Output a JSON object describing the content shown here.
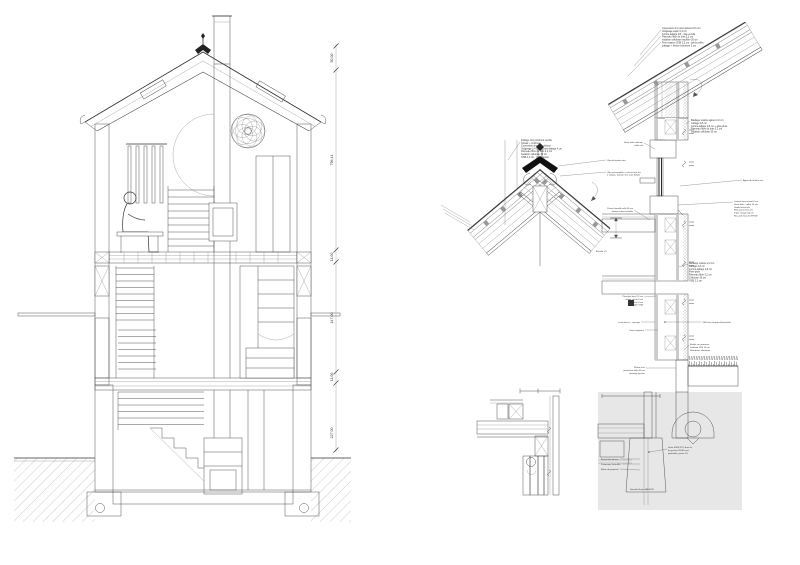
{
  "section": {
    "dimensions": [
      "50,00",
      "796,44",
      "11,00",
      "147,00",
      "11,00",
      "227,00"
    ]
  },
  "details": {
    "eave": {
      "notes": [
        "Couverture zinc joint debout 0,8 mm",
        "Voligeage sapin 2,4 cm",
        "Contre-lattage 4/6 - vide ventilé",
        "Panneau fibre de bois 2,2 cm",
        "Isolation cellulose insufflée 30 cm",
        "Frein-vapeur OSB 2,2 cm - joints collés",
        "Lattage + finition intérieure 2 cm"
      ]
    },
    "ridge": {
      "notes": [
        "Faîtage zinc préformé ventilé",
        "Closoir + crochets",
        "Couverture zinc joint debout",
        "Voligeage 2,4 cm - contre-lattage 4 cm",
        "Panneau fibre de bois 2,2 cm",
        "Isolation cellulose 30 cm",
        "OSB 2,2 cm - pare-vapeur"
      ],
      "note_right1": "Clip de fixation zinc",
      "notes_right2": [
        "Clip anti-tempête - crochet tous les",
        "2 voliges, fixation inox (voir détail)"
      ],
      "note_bottom": "Échelle 1:5"
    },
    "wall": {
      "notes_a": [
        "Bardage mélèze ajouré 2,2 cm",
        "Lattage 2,8 cm",
        "Contre-lattage 2,8 cm + pare-pluie",
        "Panneau fibre de bois 2,2 cm",
        "Isolation cellulose 30 cm"
      ],
      "note_b": "Appui de fenêtre zinc",
      "notes_c": [
        "Linteau bois massif 6 cm",
        "Store toile - coffre 10 cm",
        "Guide latéral alu",
        "Menuiserie bois-alu",
        "Triple vitrage Ug 0,6",
        "Raccord étanche EPDM"
      ],
      "notes_d": [
        "Bardage mélèze 2,2 cm",
        "Lattage 2,8 cm",
        "Contre-lattage 2,8 cm",
        "Pare-pluie",
        "Panneau fibre 2,2 cm",
        "Cellulose 30 cm",
        "OSB 2,2 cm"
      ],
      "note_e": "OSB avec bande d'étanchéité",
      "notes_f": [
        "Enduit sur panneau",
        "Isolation XPS 10 cm",
        "Membrane drainante"
      ],
      "notes_window_left": [
        "Store toile extérieur",
        "coffre alu"
      ],
      "notes_beam_left": [
        "Poutre lamellé-collé 36 cm",
        "fixation sabot invisible"
      ],
      "notes_mid_left": [
        "Plancher bois 2,5 cm",
        "chape sèche 5 cm",
        "isolation 4 cm",
        "dalle OSB"
      ],
      "note_anchor": "Lisse basse + ancrage",
      "note_joint": "Joint comprimé",
      "notes_base_left": [
        "Plinthe zinc",
        "protection delta 20 cm",
        "drainage gravier"
      ]
    },
    "foundation": {
      "notes_drain": [
        "Drain Ø100 PVC dans lit",
        "de gravier 20/40 avec",
        "géotextile, pente 1%"
      ],
      "labels_left": [
        "Étanchéité bitume",
        "Protection Delta-MS",
        "Béton de propreté"
      ],
      "note_footing": "Semelle filante BA 60/25"
    }
  }
}
